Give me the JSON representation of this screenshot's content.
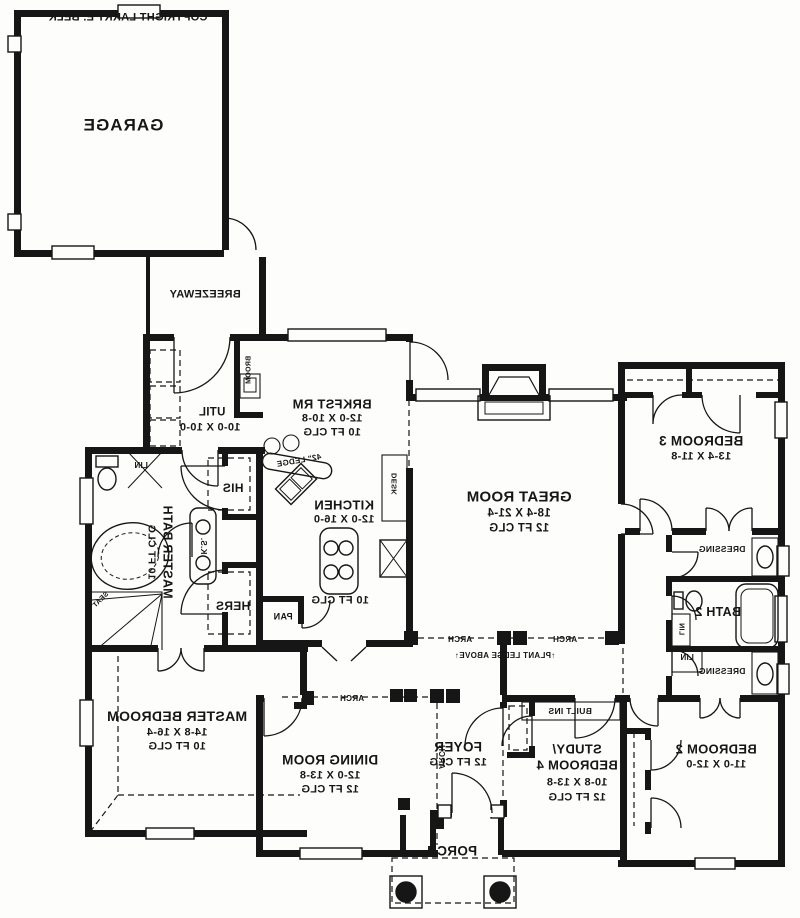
{
  "plan_title": "Mirrored single-story house floor plan",
  "annotations": {
    "copyright": "COPYRIGHT LARRY E. BELK",
    "broom": "BROOM",
    "ledge": "42\" LEDGE",
    "lin": "LIN",
    "his": "HIS",
    "hers": "HERS",
    "ks": "K.S.",
    "seat": "SEAT",
    "desk": "DESK",
    "pan": "PAN",
    "dressing": "DRESSING",
    "arch": "ARCH",
    "plant_ledge": "↑PLANT LEDGE ABOVE↑",
    "built_ins": "BUILT INS"
  },
  "rooms": {
    "garage": {
      "name": "GARAGE"
    },
    "breezeway": {
      "name": "BREEZEWAY"
    },
    "util": {
      "name": "UTIL",
      "dims": "10-0 X 10-0"
    },
    "brkfst": {
      "name": "BRKFST RM",
      "dims": "12-0 X 10-8",
      "clg": "10 FT CLG"
    },
    "master_bath": {
      "name": "MASTER BATH",
      "clg": "10 FT CLG"
    },
    "kitchen": {
      "name": "KITCHEN",
      "dims": "12-0 X 16-0",
      "clg": "10 FT CLG"
    },
    "great_room": {
      "name": "GREAT ROOM",
      "dims": "18-4 X 21-4",
      "clg": "12 FT CLG"
    },
    "bedroom3": {
      "name": "BEDROOM 3",
      "dims": "13-4 X 11-8"
    },
    "bath2": {
      "name": "BATH 2"
    },
    "master_bedroom": {
      "name": "MASTER BEDROOM",
      "dims": "14-8 X 16-4",
      "clg": "10 FT CLG"
    },
    "dining": {
      "name": "DINING ROOM",
      "dims": "12-0 X 13-8",
      "clg": "12 FT CLG"
    },
    "foyer": {
      "name": "FOYER",
      "clg": "12 FT CLG"
    },
    "study": {
      "name": "STUDY/",
      "name2": "BEDROOM 4",
      "dims": "10-8 X 13-8",
      "clg": "12 FT CLG"
    },
    "bedroom2": {
      "name": "BEDROOM 2",
      "dims": "11-0 X 12-0"
    },
    "porch": {
      "name": "PORCH"
    }
  },
  "colors": {
    "ink": "#161616",
    "paper": "#fdfdfc"
  }
}
